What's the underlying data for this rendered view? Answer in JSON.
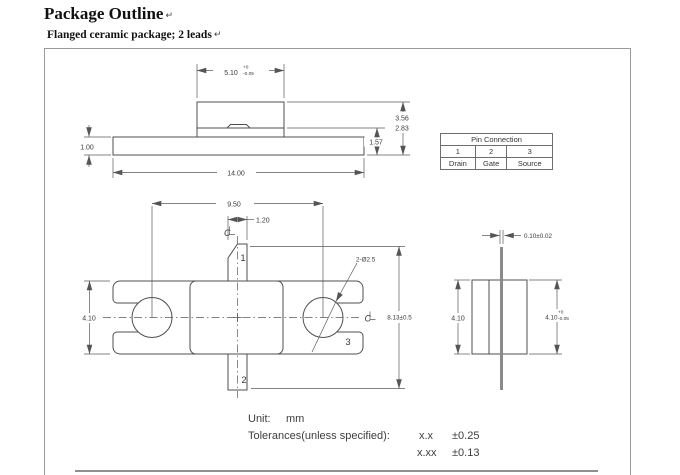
{
  "title": {
    "text": "Package Outline",
    "mark": "↵"
  },
  "subtitle": {
    "text": "Flanged ceramic package; 2 leads",
    "mark": "↵"
  },
  "front_view": {
    "cap_width": "5.10",
    "cap_width_tol_plus": "+0",
    "cap_width_tol_minus": "-0.05",
    "height_total": "3.56",
    "height_to_seal": "2.83",
    "height_lead": "1.57",
    "flange_thickness": "1.00",
    "flange_length": "14.00"
  },
  "pin_table": {
    "title": "Pin Connection",
    "pins": [
      "1",
      "2",
      "3"
    ],
    "functions": [
      "Drain",
      "Gate",
      "Source"
    ]
  },
  "bottom_view": {
    "hole_pitch": "9.50",
    "lead_width": "1.20",
    "hole_callout": "2-Ø2.5",
    "flange_width": "4.10",
    "lead_tip_span": "8.13±0.5",
    "pin1_label": "1",
    "pin2_label": "2",
    "pin3_label": "3",
    "centerline_glyph": "C"
  },
  "side_view": {
    "lead_thickness": "0.10±0.02",
    "flange_width": "4.10",
    "body_width": "4.10",
    "body_width_tol_plus": "+0",
    "body_width_tol_minus": "-0.05"
  },
  "notes": {
    "unit_label": "Unit:",
    "unit_value": "mm",
    "tolerance_label": "Tolerances(unless specified):",
    "tolerances": [
      {
        "precision": "x.x",
        "value": "±0.25"
      },
      {
        "precision": "x.xx",
        "value": "±0.13"
      }
    ]
  }
}
